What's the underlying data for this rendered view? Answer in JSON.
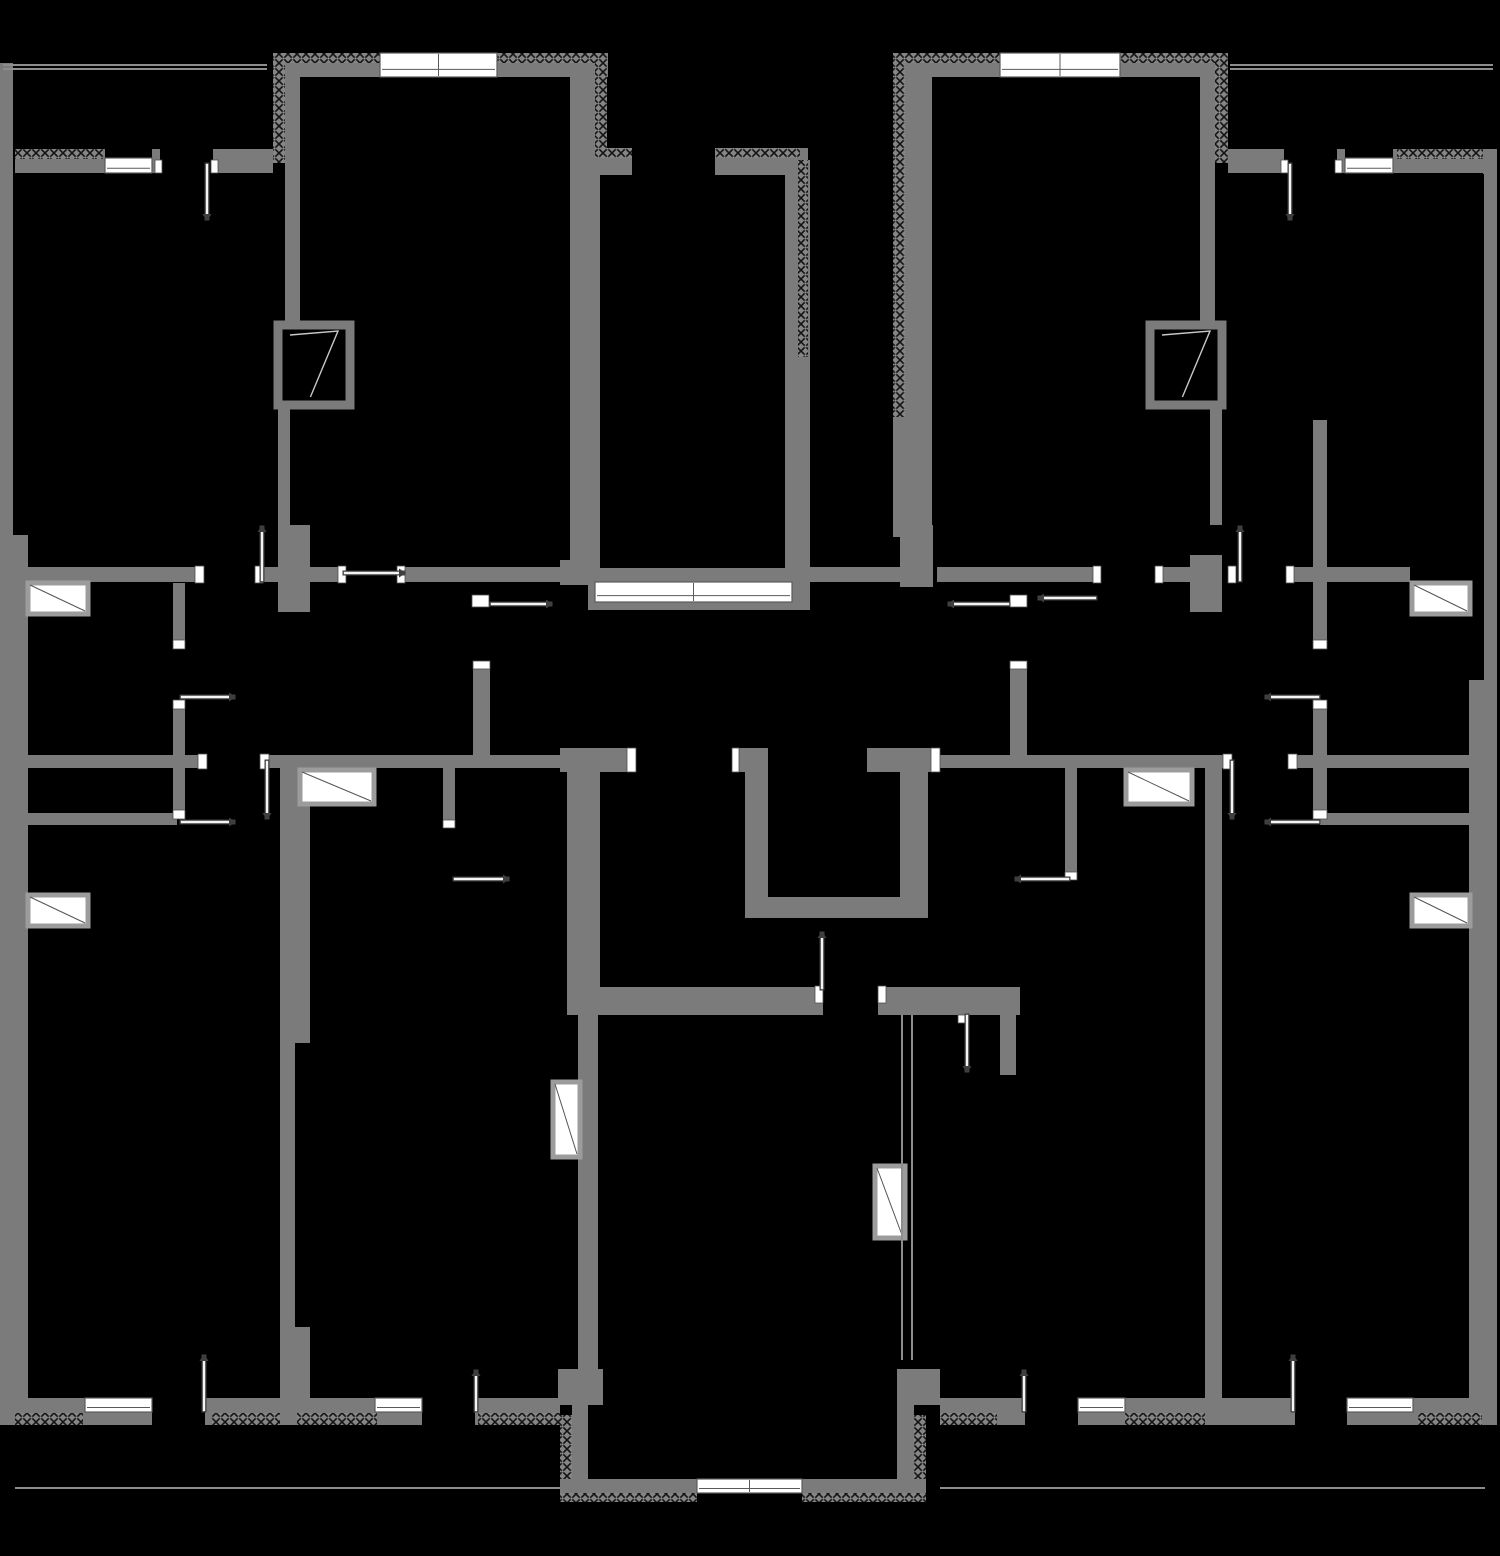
{
  "canvas": {
    "width": 1500,
    "height": 1556,
    "background": "#000000"
  },
  "legend": {
    "wall_color": "#7b7b7b",
    "hatch_base_color": "#858585",
    "hatch_mark_color": "#141414",
    "window_fill": "#ffffff",
    "window_frame": "#5a5a5a",
    "sill_border": "#9c9c9c",
    "sill_line": "#c8c8c8",
    "rail_color": "#8d8d8d",
    "door_leaf_outline": "#3e3e3e",
    "door_leaf_fill": "#f4f4f4",
    "jamb_fill": "#ffffff",
    "jamb_frame": "#4f4f4f"
  },
  "plan": {
    "walls": [
      [
        0,
        63,
        13,
        472
      ],
      [
        0,
        535,
        28,
        863
      ],
      [
        1484,
        150,
        13,
        530
      ],
      [
        1469,
        680,
        28,
        718
      ],
      [
        0,
        1398,
        560,
        27
      ],
      [
        940,
        1398,
        557,
        27
      ],
      [
        15,
        149,
        90,
        24
      ],
      [
        152,
        149,
        8,
        24
      ],
      [
        213,
        149,
        60,
        24
      ],
      [
        273,
        53,
        335,
        24
      ],
      [
        273,
        53,
        27,
        110
      ],
      [
        285,
        163,
        15,
        162
      ],
      [
        278,
        405,
        12,
        120
      ],
      [
        278,
        525,
        32,
        87
      ],
      [
        570,
        63,
        30,
        519
      ],
      [
        595,
        148,
        37,
        27
      ],
      [
        715,
        148,
        93,
        27
      ],
      [
        785,
        160,
        25,
        450
      ],
      [
        588,
        568,
        207,
        42
      ],
      [
        560,
        560,
        40,
        25
      ],
      [
        893,
        57,
        39,
        480
      ],
      [
        900,
        525,
        33,
        62
      ],
      [
        893,
        53,
        335,
        24
      ],
      [
        1215,
        53,
        13,
        110
      ],
      [
        1200,
        62,
        15,
        263
      ],
      [
        1210,
        405,
        12,
        120
      ],
      [
        1190,
        555,
        32,
        57
      ],
      [
        1228,
        149,
        56,
        24
      ],
      [
        1337,
        149,
        8,
        24
      ],
      [
        1393,
        149,
        90,
        24
      ],
      [
        1483,
        149,
        14,
        25
      ],
      [
        28,
        567,
        172,
        15
      ],
      [
        255,
        567,
        88,
        15
      ],
      [
        397,
        567,
        163,
        15
      ],
      [
        802,
        567,
        103,
        15
      ],
      [
        937,
        567,
        160,
        15
      ],
      [
        1163,
        567,
        59,
        15
      ],
      [
        1290,
        567,
        120,
        15
      ],
      [
        28,
        755,
        172,
        13
      ],
      [
        267,
        755,
        300,
        13
      ],
      [
        940,
        755,
        285,
        13
      ],
      [
        1288,
        755,
        209,
        13
      ],
      [
        173,
        583,
        12,
        65
      ],
      [
        173,
        702,
        12,
        116
      ],
      [
        28,
        813,
        149,
        12
      ],
      [
        1313,
        420,
        14,
        228
      ],
      [
        1313,
        702,
        14,
        116
      ],
      [
        1320,
        813,
        150,
        12
      ],
      [
        443,
        768,
        12,
        60
      ],
      [
        1065,
        768,
        12,
        112
      ],
      [
        473,
        668,
        17,
        87
      ],
      [
        1010,
        668,
        17,
        87
      ],
      [
        560,
        748,
        75,
        24
      ],
      [
        732,
        748,
        36,
        24
      ],
      [
        867,
        748,
        73,
        24
      ],
      [
        567,
        772,
        33,
        243
      ],
      [
        745,
        772,
        23,
        146
      ],
      [
        768,
        897,
        132,
        21
      ],
      [
        900,
        772,
        28,
        146
      ],
      [
        567,
        987,
        256,
        28
      ],
      [
        878,
        987,
        142,
        28
      ],
      [
        1000,
        1015,
        16,
        60
      ],
      [
        578,
        1015,
        20,
        385
      ],
      [
        280,
        768,
        30,
        275
      ],
      [
        280,
        1043,
        15,
        284
      ],
      [
        280,
        1327,
        30,
        71
      ],
      [
        1205,
        768,
        17,
        630
      ],
      [
        558,
        1369,
        45,
        36
      ],
      [
        897,
        1369,
        43,
        36
      ],
      [
        572,
        1405,
        16,
        74
      ],
      [
        897,
        1405,
        17,
        74
      ],
      [
        560,
        1479,
        366,
        14
      ]
    ],
    "hatched_walls": [
      [
        273,
        53,
        335,
        10
      ],
      [
        893,
        53,
        335,
        10
      ],
      [
        273,
        53,
        12,
        110
      ],
      [
        595,
        63,
        12,
        95
      ],
      [
        595,
        148,
        37,
        10
      ],
      [
        715,
        148,
        85,
        10
      ],
      [
        798,
        160,
        10,
        197
      ],
      [
        893,
        57,
        12,
        360
      ],
      [
        1215,
        53,
        13,
        110
      ],
      [
        15,
        149,
        88,
        10
      ],
      [
        1397,
        149,
        86,
        10
      ],
      [
        15,
        1413,
        68,
        12
      ],
      [
        212,
        1413,
        68,
        12
      ],
      [
        297,
        1413,
        80,
        12
      ],
      [
        478,
        1413,
        82,
        12
      ],
      [
        940,
        1413,
        57,
        12
      ],
      [
        1125,
        1413,
        80,
        12
      ],
      [
        1418,
        1413,
        64,
        12
      ],
      [
        560,
        1415,
        12,
        64
      ],
      [
        914,
        1415,
        12,
        64
      ],
      [
        560,
        1493,
        137,
        9
      ],
      [
        802,
        1493,
        124,
        9
      ]
    ],
    "door_cuts": [
      [
        152,
        1398,
        53,
        27
      ],
      [
        422,
        1398,
        53,
        27
      ],
      [
        1025,
        1398,
        53,
        27
      ],
      [
        1295,
        1398,
        52,
        27
      ]
    ],
    "windows": [
      [
        380,
        53,
        117,
        24
      ],
      [
        1000,
        53,
        120,
        24
      ],
      [
        105,
        158,
        47,
        15
      ],
      [
        1345,
        158,
        48,
        15
      ],
      [
        595,
        582,
        197,
        20
      ],
      [
        85,
        1398,
        67,
        14
      ],
      [
        375,
        1398,
        47,
        14
      ],
      [
        1078,
        1398,
        47,
        14
      ],
      [
        1347,
        1398,
        66,
        14
      ],
      [
        697,
        1479,
        105,
        14
      ]
    ],
    "sills_light": [
      [
        28,
        583,
        60,
        31
      ],
      [
        28,
        895,
        60,
        31
      ],
      [
        1412,
        583,
        58,
        31
      ],
      [
        1412,
        895,
        58,
        31
      ],
      [
        300,
        770,
        74,
        34
      ],
      [
        1126,
        770,
        66,
        34
      ],
      [
        553,
        1082,
        27,
        75
      ],
      [
        875,
        1166,
        30,
        72
      ]
    ],
    "sills_dark": [
      [
        278,
        325,
        72,
        80
      ],
      [
        1150,
        325,
        72,
        80
      ]
    ],
    "rails": [
      [
        3,
        64,
        264,
        2
      ],
      [
        3,
        68,
        264,
        2
      ],
      [
        1230,
        64,
        263,
        2
      ],
      [
        1230,
        68,
        263,
        2
      ],
      [
        15,
        1487,
        545,
        2
      ],
      [
        940,
        1487,
        545,
        2
      ],
      [
        901,
        1015,
        2,
        345
      ],
      [
        911,
        1015,
        2,
        345
      ]
    ],
    "jambs": [
      [
        195,
        566,
        9,
        17
      ],
      [
        255,
        566,
        8,
        17
      ],
      [
        338,
        566,
        8,
        17
      ],
      [
        397,
        566,
        8,
        17
      ],
      [
        1093,
        566,
        8,
        17
      ],
      [
        1155,
        566,
        8,
        17
      ],
      [
        1228,
        566,
        8,
        17
      ],
      [
        1286,
        566,
        8,
        17
      ],
      [
        198,
        754,
        9,
        15
      ],
      [
        260,
        754,
        9,
        15
      ],
      [
        1223,
        754,
        9,
        15
      ],
      [
        1288,
        754,
        9,
        15
      ],
      [
        173,
        640,
        12,
        9
      ],
      [
        173,
        700,
        12,
        9
      ],
      [
        173,
        810,
        12,
        9
      ],
      [
        1313,
        640,
        14,
        9
      ],
      [
        1313,
        700,
        14,
        9
      ],
      [
        1313,
        810,
        14,
        9
      ],
      [
        627,
        748,
        9,
        24
      ],
      [
        732,
        748,
        7,
        24
      ],
      [
        931,
        748,
        9,
        24
      ],
      [
        815,
        986,
        8,
        17
      ],
      [
        878,
        986,
        8,
        17
      ],
      [
        958,
        1015,
        9,
        8
      ],
      [
        155,
        160,
        7,
        13
      ],
      [
        211,
        160,
        7,
        13
      ],
      [
        1281,
        160,
        7,
        13
      ],
      [
        1335,
        160,
        7,
        13
      ],
      [
        443,
        820,
        12,
        8
      ],
      [
        1065,
        872,
        12,
        8
      ],
      [
        472,
        595,
        17,
        12
      ],
      [
        1010,
        595,
        17,
        12
      ],
      [
        473,
        661,
        17,
        8
      ],
      [
        1010,
        661,
        17,
        8
      ]
    ],
    "doors": [
      [
        207,
        165,
        207,
        218
      ],
      [
        1290,
        165,
        1290,
        218
      ],
      [
        262,
        580,
        262,
        528
      ],
      [
        1240,
        580,
        1240,
        528
      ],
      [
        345,
        573,
        403,
        573
      ],
      [
        1095,
        598,
        1040,
        598
      ],
      [
        492,
        604,
        550,
        604
      ],
      [
        1008,
        604,
        950,
        604
      ],
      [
        182,
        697,
        233,
        697
      ],
      [
        182,
        822,
        233,
        822
      ],
      [
        1318,
        697,
        1267,
        697
      ],
      [
        1318,
        822,
        1267,
        822
      ],
      [
        267,
        762,
        267,
        817
      ],
      [
        1232,
        762,
        1232,
        817
      ],
      [
        455,
        879,
        507,
        879
      ],
      [
        1068,
        879,
        1017,
        879
      ],
      [
        822,
        988,
        822,
        934
      ],
      [
        967,
        1016,
        967,
        1070
      ],
      [
        204,
        1410,
        204,
        1357
      ],
      [
        1293,
        1410,
        1293,
        1357
      ],
      [
        476,
        1410,
        476,
        1372
      ],
      [
        1024,
        1410,
        1024,
        1372
      ]
    ]
  }
}
